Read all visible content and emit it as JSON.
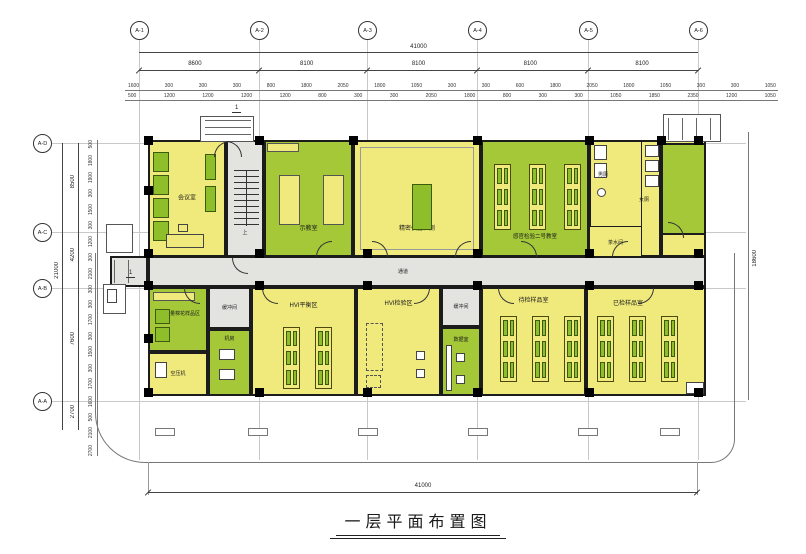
{
  "title": "一层平面布置图",
  "axes": {
    "top": [
      "A-1",
      "A-2",
      "A-3",
      "A-4",
      "A-5",
      "A-6"
    ],
    "left": [
      "A-D",
      "A-C",
      "A-B",
      "A-A"
    ]
  },
  "dims": {
    "top_total": "41000",
    "top_bays": [
      "8600",
      "8100",
      "8100",
      "8100",
      "8100"
    ],
    "top_sub1": [
      "1600",
      "300",
      "300",
      "300",
      "800",
      "1800",
      "2050",
      "1800",
      "1050",
      "300",
      "300",
      "600",
      "1800",
      "2050",
      "1800",
      "1050",
      "300",
      "300",
      "1050"
    ],
    "top_sub2": [
      "500",
      "1200",
      "1200",
      "1200",
      "1200",
      "800",
      "300",
      "300",
      "2050",
      "1800",
      "800",
      "300",
      "300",
      "1050",
      "1850",
      "2350",
      "1200",
      "1050"
    ],
    "left_total": "21000",
    "left_bays": [
      "8500",
      "4200",
      "7600",
      "2700"
    ],
    "left_sub": [
      "500",
      "1800",
      "1900",
      "300",
      "1500",
      "300",
      "1200",
      "300",
      "2100",
      "300",
      "300",
      "1700",
      "300",
      "1500",
      "300",
      "1700",
      "1600",
      "500",
      "2100",
      "2700"
    ],
    "right_total": "18600",
    "bottom_total": "41000"
  },
  "rooms": {
    "meeting": "会议室",
    "demo": "示教室",
    "precision": "精密仪器检测",
    "classroom": "感官检验二号教室",
    "toilet_m": "男厕",
    "toilet_f": "女厕",
    "tea": "茶水间",
    "sample_area": "大容量棉花样品区",
    "compressor": "空压机",
    "buffer": "缓冲间",
    "machine": "机房",
    "hvi_balance": "HVI平衡区",
    "hvi_test": "HVI检验区",
    "data": "数据室",
    "pending": "待检样品室",
    "checked": "已检样品室"
  },
  "labels": {
    "corridor": "通道",
    "stair_up": "上",
    "section_marker": "1"
  },
  "colors": {
    "room_yellow": "#F0EA7D",
    "room_green": "#A4C838",
    "furniture_green": "#8FBE2B",
    "corridor_gray": "#E3E3E0",
    "wall": "#1C1C1C",
    "dimension": "#333333"
  }
}
